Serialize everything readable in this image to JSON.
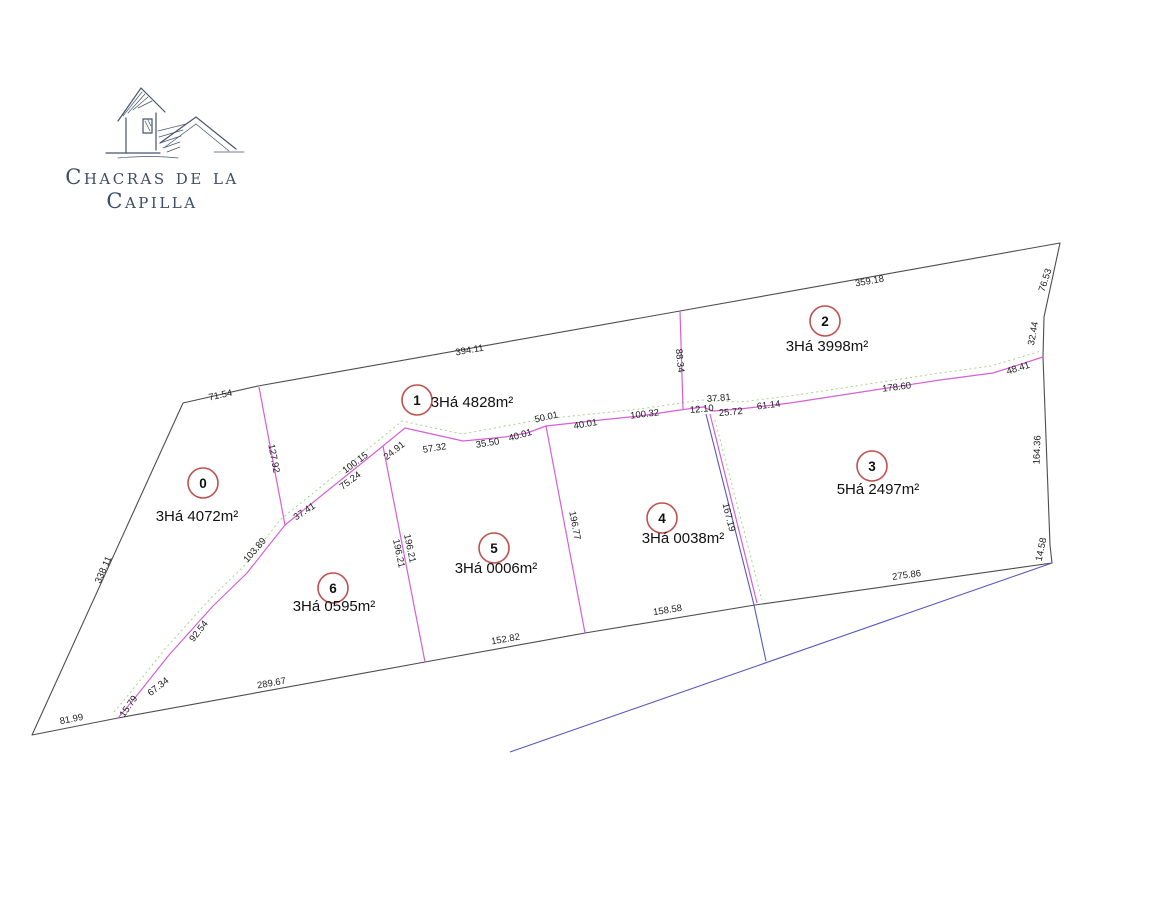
{
  "logo": {
    "icon": "chapel-sketch",
    "line1": "Chacras de la",
    "line2": "Capilla"
  },
  "plan": {
    "lots": [
      {
        "num": "0",
        "area": "3Há 4072m²"
      },
      {
        "num": "1",
        "area": "3Há 4828m²"
      },
      {
        "num": "2",
        "area": "3Há 3998m²"
      },
      {
        "num": "3",
        "area": "5Há 2497m²"
      },
      {
        "num": "4",
        "area": "3Há 0038m²"
      },
      {
        "num": "5",
        "area": "3Há 0006m²"
      },
      {
        "num": "6",
        "area": "3Há 0595m²"
      }
    ],
    "dims": [
      "394.11",
      "359.18",
      "76.53",
      "32.44",
      "48.41",
      "178.60",
      "61.14",
      "37.81",
      "25.72",
      "12.10",
      "100.32",
      "40.01",
      "50.01",
      "40.01",
      "35.50",
      "57.32",
      "24.91",
      "88.34",
      "71.54",
      "127.92",
      "100.15",
      "75.24",
      "37.41",
      "103.89",
      "92.54",
      "67.34",
      "15.79",
      "81.99",
      "338.11",
      "289.67",
      "152.82",
      "158.58",
      "275.86",
      "164.36",
      "14.58",
      "167.19",
      "196.21",
      "196.21",
      "196.77"
    ]
  },
  "colors": {
    "boundary": "#4d4d4d",
    "divider_magenta": "#d560d5",
    "utility_blue": "#5757bd",
    "vegetation_green": "#a5d48d",
    "lot_badge_red": "#c0504d",
    "logo_navy": "#3e4d66",
    "background": "#ffffff"
  }
}
